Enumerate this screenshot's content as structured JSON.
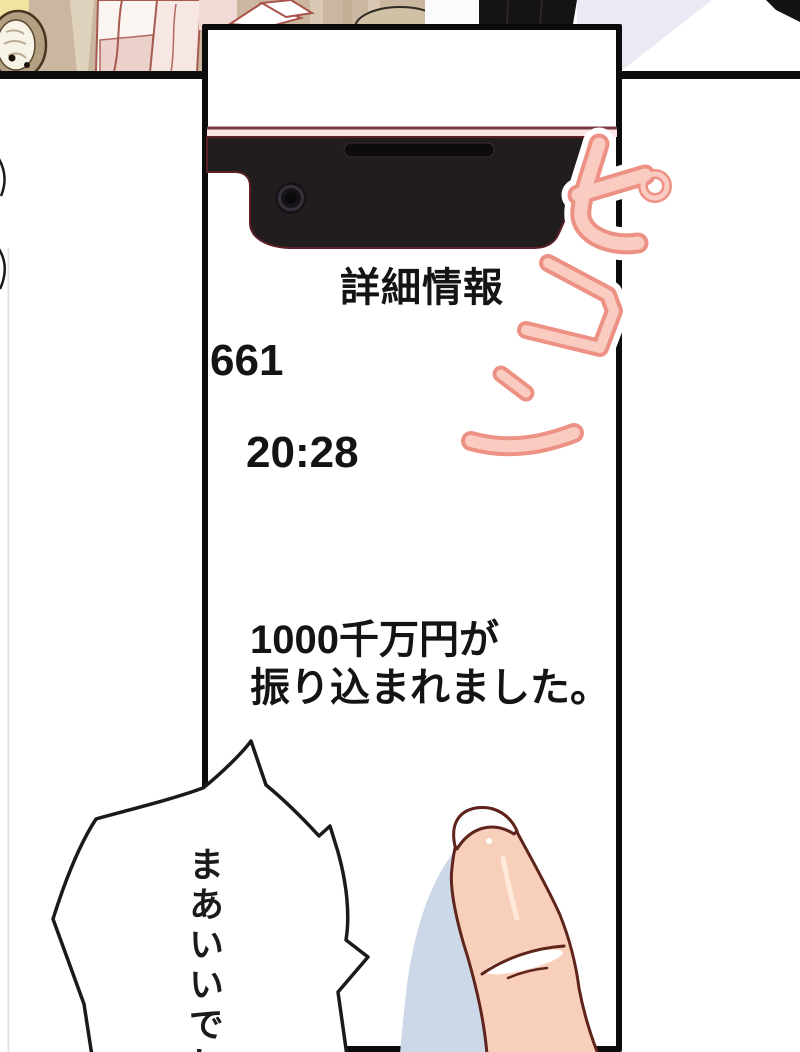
{
  "page": {
    "kind": "manga page with smartphone close-up panel",
    "background": "#ffffff"
  },
  "top_panel": {
    "description": "sliver of previous panel: beige room with clock, figure in pink, figure in black on lavender",
    "colors": {
      "wall_beige": "#cbb79f",
      "light_band": "#e0d3bd",
      "lavender": "#ebe9f3",
      "figure_black": "#161314",
      "clock_frame": "#b3a082",
      "pink_cloth": "#ecd0ca"
    }
  },
  "phone_panel": {
    "border_color": "#0c0c0c",
    "bezel_line_color": "#7b3742",
    "body_black": "#211d1f",
    "screen": {
      "title": "詳細情報",
      "count": "661",
      "time": "20:28",
      "message_line1": "1000千万円が",
      "message_line2": "振り込まれました。"
    }
  },
  "sfx": {
    "text": "ピコン",
    "chars": [
      "ピ",
      "コ",
      "ン"
    ],
    "fill": "#f9cbc1",
    "outline": "#ed9184",
    "glow": "#ffffff"
  },
  "speech_bubble": {
    "text": "まあいいでし",
    "outline": "#1a1a1a",
    "fill": "#ffffff"
  },
  "finger": {
    "skin": "#f8cfba",
    "outline": "#5f241c",
    "nail": "#fdfdfd",
    "shadow": "#ccd7e8"
  }
}
